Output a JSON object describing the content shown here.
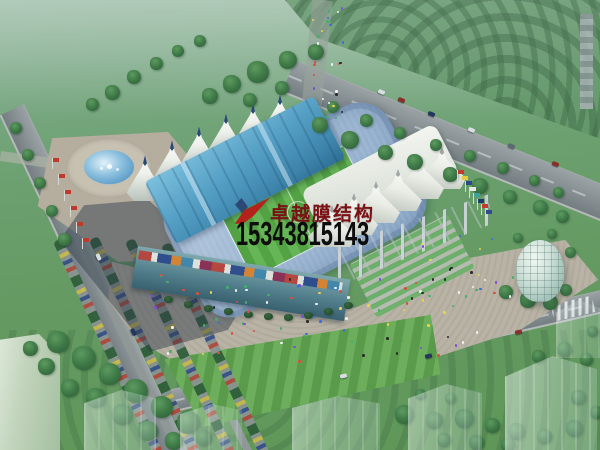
{
  "image": {
    "type": "architectural-aerial-rendering",
    "subject": "Bird's-eye rendering of a tensile-membrane roof stadium complex with green pitch, blue grandstand roof, white tent canopies, fountain plaza, glass dome pavilion, tree-lined roads and parking"
  },
  "watermark": {
    "logo_icon": "swoosh-logo-icon",
    "company_name": "卓越膜结构",
    "company_color": "#7a1115",
    "phone_number": "15343815143",
    "phone_color": "#0d0d0d"
  },
  "palette": {
    "canopy_white": "#eef1ec",
    "grandstand_roof_blue": "#4e93b8",
    "pitch_green": "#58a647",
    "lawn_green": "#679c66",
    "plaza_tan": "#b7b1a3",
    "road_gray": "#8a9296",
    "fountain_water_blue": "#5b9bc8",
    "dome_glass_green": "#c9ded6"
  },
  "scene_elements": [
    "stadium",
    "membrane-tent-roofs",
    "east-canopy-pylons",
    "football-pitch",
    "blue-roof-grandstand",
    "fountain-plaza",
    "glass-dome-pavilion",
    "parking-rows",
    "tree-lined-avenue",
    "highway",
    "south-road",
    "flag-rows",
    "crowds",
    "ghost-buildings",
    "lawn-terraces"
  ]
}
